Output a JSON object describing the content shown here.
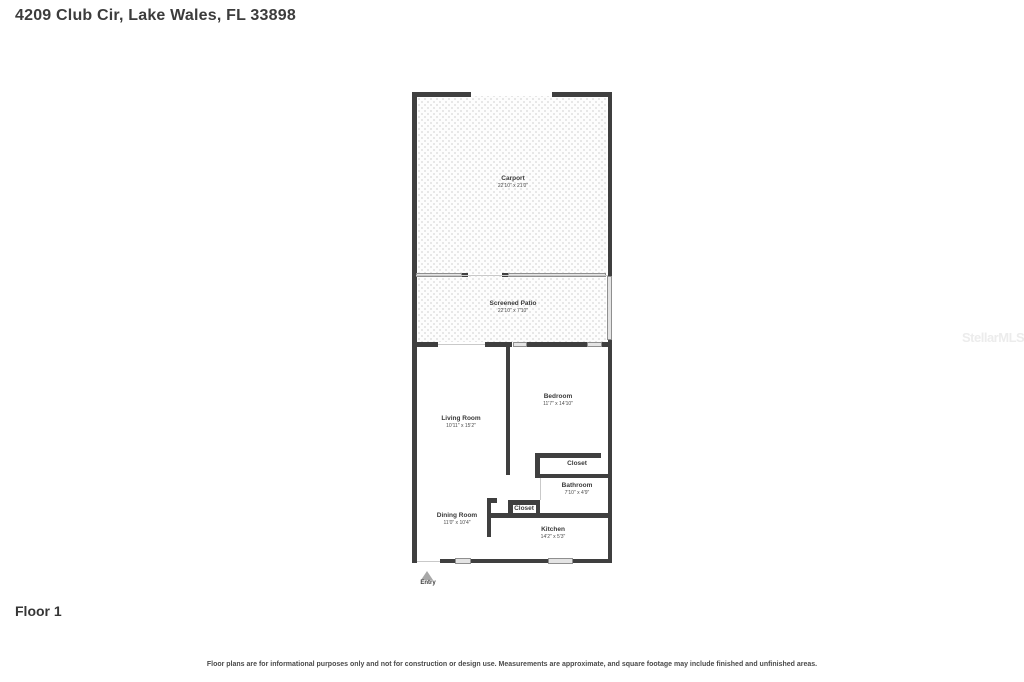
{
  "page": {
    "title": "4209 Club Cir, Lake Wales, FL 33898",
    "floor_label": "Floor 1",
    "disclaimer": "Floor plans are for informational purposes only and not for construction or design use. Measurements are approximate, and square footage may include finished and unfinished areas.",
    "watermark": "StellarMLS"
  },
  "floorplan": {
    "entry_label": "Entry",
    "rooms": [
      {
        "name": "Carport",
        "dimensions": "22'10\" x 21'0\""
      },
      {
        "name": "Screened Patio",
        "dimensions": "22'10\" x 7'10\""
      },
      {
        "name": "Living Room",
        "dimensions": "10'11\" x 15'2\""
      },
      {
        "name": "Bedroom",
        "dimensions": "11'7\" x 14'10\""
      },
      {
        "name": "Closet",
        "dimensions": ""
      },
      {
        "name": "Bathroom",
        "dimensions": "7'10\" x 4'9\""
      },
      {
        "name": "Closet",
        "dimensions": ""
      },
      {
        "name": "Dining Room",
        "dimensions": "11'0\" x 10'4\""
      },
      {
        "name": "Kitchen",
        "dimensions": "14'2\" x 5'3\""
      }
    ],
    "colors": {
      "wall": "#3f3f3f",
      "window_fill": "#e4e4e4",
      "pattern_dot": "#e3e3e3"
    }
  }
}
